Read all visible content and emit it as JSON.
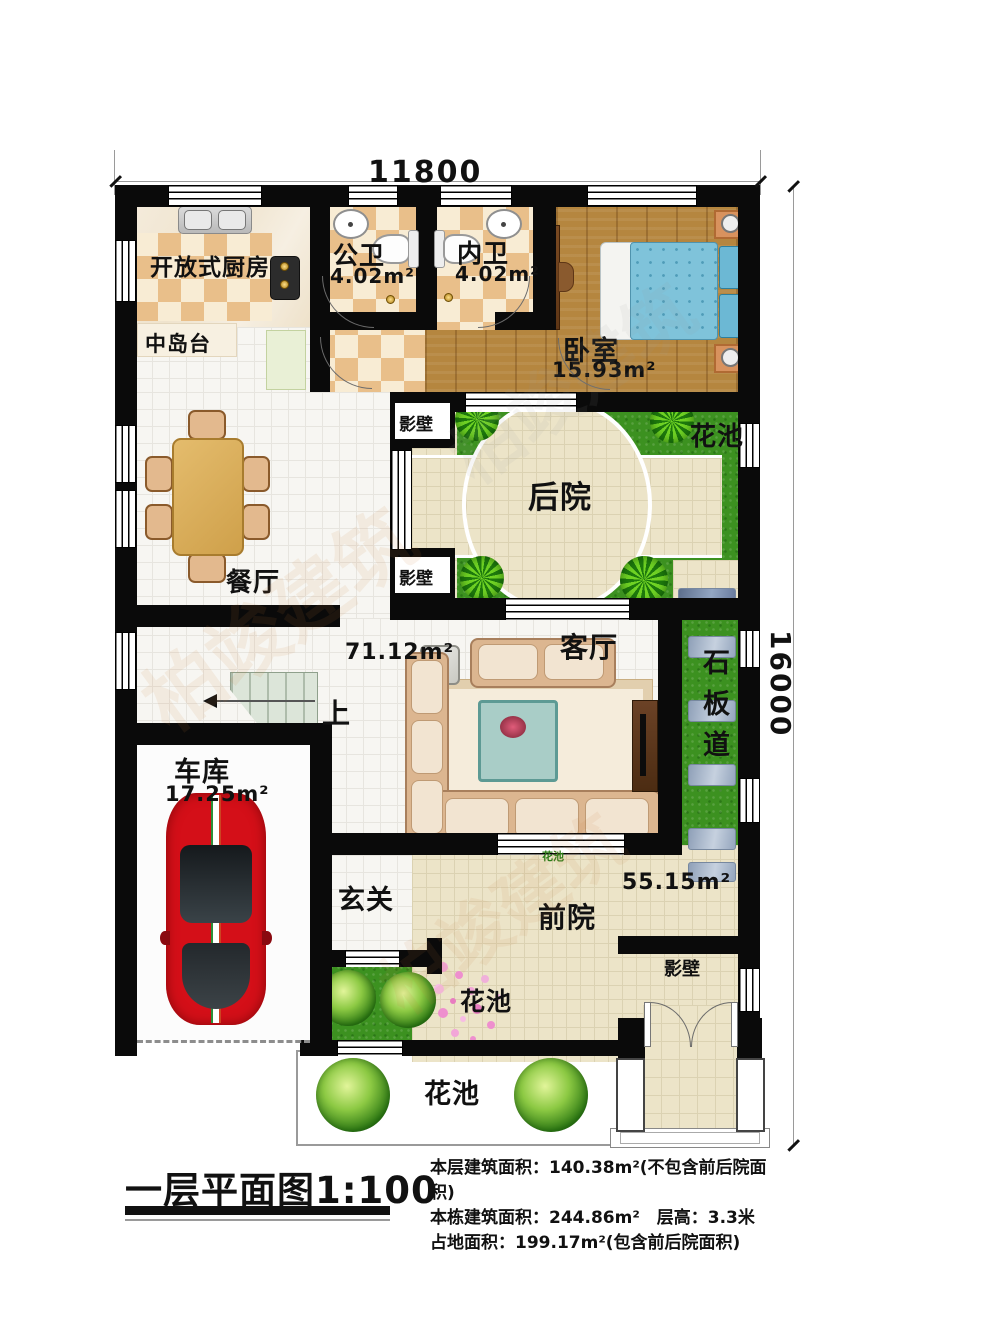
{
  "dimensions": {
    "width_top": "11800",
    "height_right": "16000"
  },
  "rooms": {
    "kitchen": {
      "label": "开放式厨房"
    },
    "island": {
      "label": "中岛台"
    },
    "public_bath": {
      "label": "公卫",
      "area": "4.02m²"
    },
    "inner_bath": {
      "label": "内卫",
      "area": "4.02m²"
    },
    "bedroom": {
      "label": "卧室",
      "area": "15.93m²"
    },
    "backyard": {
      "label": "后院"
    },
    "dining": {
      "label": "餐厅"
    },
    "living": {
      "label": "客厅",
      "area": "71.12m²"
    },
    "stone_path": {
      "label": "石板道"
    },
    "stairs": {
      "label": "上"
    },
    "garage": {
      "label": "车库",
      "area": "17.25m²"
    },
    "foyer": {
      "label": "玄关"
    },
    "front_yard": {
      "label": "前院",
      "area": "55.15m²"
    },
    "screen_wall_top": {
      "label": "影壁"
    },
    "screen_wall_bottom": {
      "label": "影壁"
    },
    "screen_wall_front": {
      "label": "影壁"
    },
    "flower_bed_right": {
      "label": "花池"
    },
    "flower_bed_small": {
      "label": "花池"
    },
    "flower_bed_mid": {
      "label": "花池"
    },
    "flower_bed_bottom": {
      "label": "花池"
    }
  },
  "footer": {
    "title": "一层平面图1:100",
    "info_lines": [
      "本层建筑面积：140.38m²(不包含前后院面积)",
      "本栋建筑面积：244.86m²　层高：3.3米",
      "占地面积：199.17m²(包含前后院面积)"
    ]
  },
  "watermark": {
    "text": "柏竣建筑"
  },
  "colors": {
    "wall": "#0a0a0a",
    "checker_tan": "#e9bf8a",
    "checker_cream": "#f8ecd4",
    "wood_floor": "#b5863f",
    "grass": "#3c9120",
    "paving": "#ece4c8",
    "bed_blue": "#7fc3da",
    "car_red": "#d40f18",
    "stone_slab": "#a3b2c7"
  }
}
